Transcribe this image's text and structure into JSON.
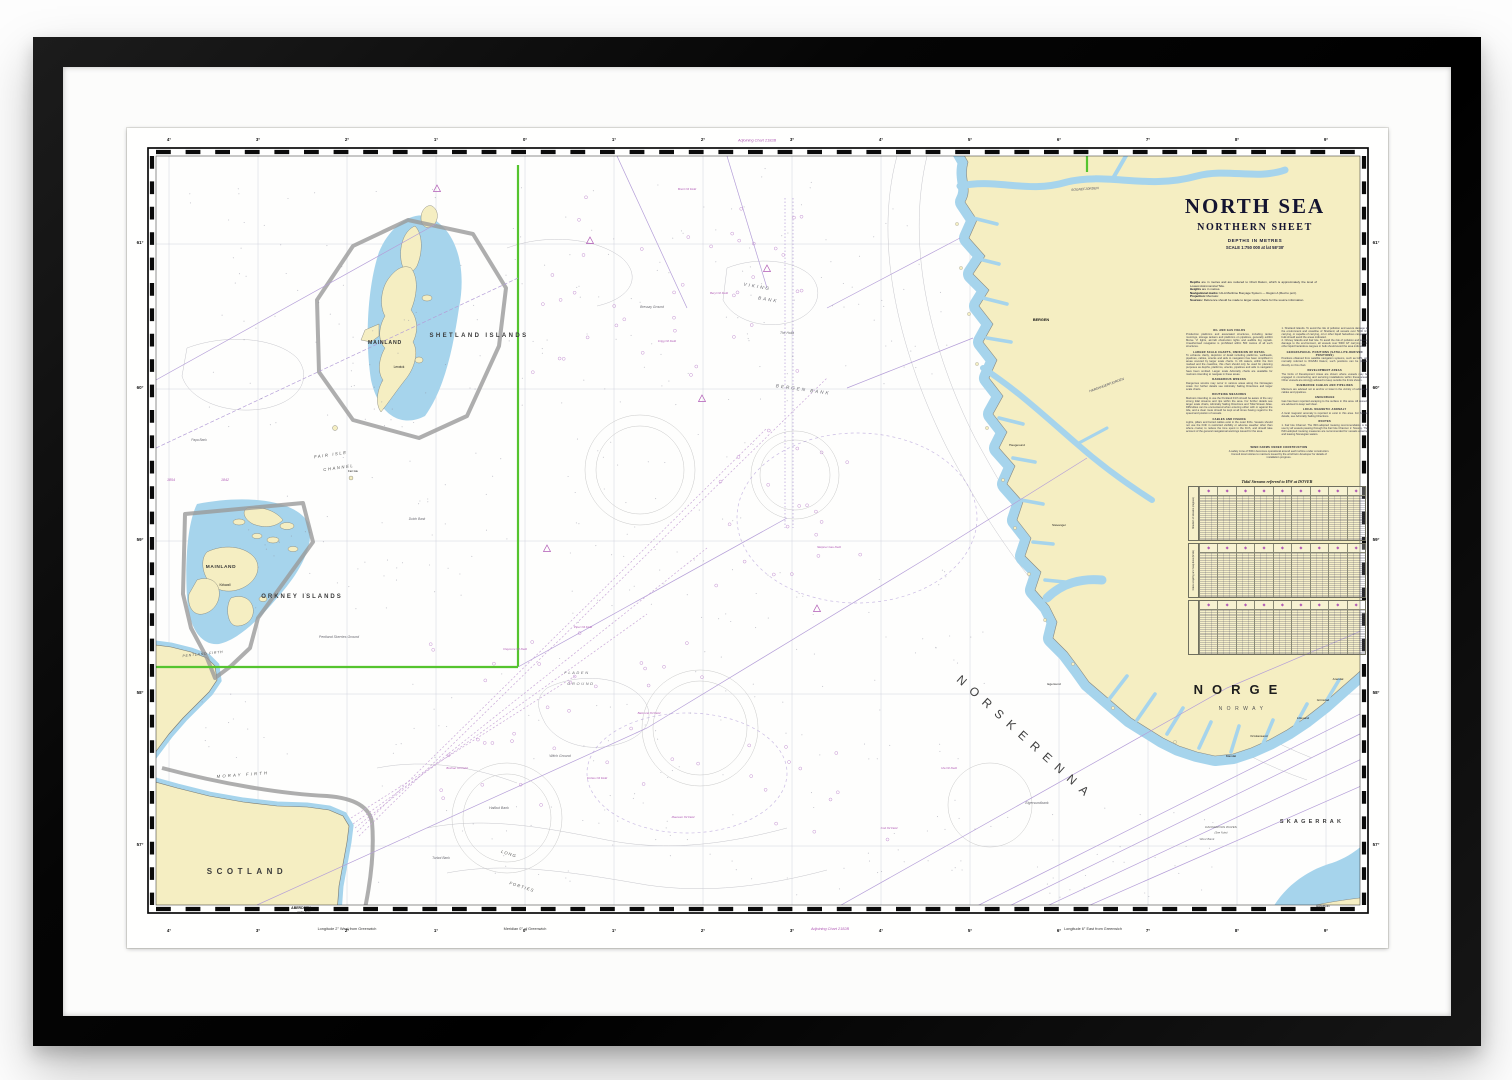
{
  "artwork": {
    "title": "NORTH SEA",
    "subtitle": "NORTHERN SHEET",
    "depths_line": "DEPTHS IN METRES",
    "scale_line": "SCALE 1:750 000 at lat 58°30'",
    "intro": [
      {
        "lead": "Depths",
        "text": "are in metres and are reduced to Chart Datum, which is approximately the level of Lowest Astronomical Tide."
      },
      {
        "lead": "Heights",
        "text": "are in metres."
      },
      {
        "lead": "Navigational marks:",
        "text": "IALA Maritime Buoyage System — Region A (Red to port)."
      },
      {
        "lead": "Projection:",
        "text": "Mercator."
      },
      {
        "lead": "Sources:",
        "text": "Reference should be made to larger scale charts for the source information."
      }
    ]
  },
  "notes_col1": [
    {
      "h": "OIL AND GAS FIELDS",
      "p": "Production platforms and associated structures, including tanker moorings, storage tankers and platforms on pipelines, generally exhibit Morse 'U' lights, aircraft obstruction lights and audible fog signals. Unauthorised navigation is prohibited within 500 metres of all such structures."
    },
    {
      "h": "LARGER SCALE CHARTS, OMISSION OF DETAIL",
      "p": "To enhance clarity, depiction of detail including platforms, wellheads, pipelines, cables, wrecks and aids to navigation has been simplified in areas covered by larger scale charts. In UK waters, within the limit marked and the coastline, this chart should only be used for planning purposes as depths, platforms, wrecks, pipelines and aids to navigation have been omitted. Larger scale Admiralty charts are available for mariners intending to navigate in these areas."
    },
    {
      "h": "DANGEROUS WRECKS",
      "p": "Dangerous wrecks may occur in various areas along the Norwegian coast. For further details see Admiralty Sailing Directions and larger scale charts."
    },
    {
      "h": "ROUTEING MEASURES",
      "p": "Mariners intending to use the Pentland Firth should be aware of the very strong tidal streams and rips within the area. For further details see larger scale charts, Admiralty Sailing Directions and Tidal Stream Atlas. Difficulties can be encountered when entering either with or against the tide, and a clear route should be kept at all times having regard to the speed and position of vessels."
    },
    {
      "h": "CABLES AND FISHING",
      "p": "Lights, pillars and buried cables exist in the outer firths. Vessels should not use the Firth in restricted visibility or adverse weather other than where crucial, to reduce the time spent in the Firth, and should take account of the general navigational warnings issued for the area."
    }
  ],
  "notes_col2": [
    {
      "h": "",
      "p": "1. Shetland Islands. To avoid the risk of pollution and severe damage to the environment and coastline of Shetland, all vessels over 5000 GT carrying, or capable of carrying, oil or other liquid hazardous cargoes in bulk should avoid the areas indicated."
    },
    {
      "h": "",
      "p": "2. Orkney Islands and Fair Isle. To avoid the risk of pollution and severe damage to the environment, all vessels over 5000 GT carrying oil or other liquid hazardous cargoes in bulk should avoid the area indicated."
    },
    {
      "h": "GEOGRAPHICAL POSITIONS (SATELLITE-DERIVED POSITIONS)",
      "p": "Positions obtained from satellite navigation systems, such as GPS, are normally referred to WGS84 Datum; such positions can be plotted directly on this chart."
    },
    {
      "h": "DEVELOPMENT AREAS",
      "p": "The limits of Development Areas are shown where vessels may be engaged in constructing and servicing installations within these areas. Other vessels are strongly advised to keep outside the limits shown."
    },
    {
      "h": "SUBMARINE CABLES AND PIPELINES",
      "p": "Mariners are advised not to anchor or trawl in the vicinity of submarine cables and pipelines."
    },
    {
      "h": "ANCHORAGE",
      "p": "Gas has been reported escaping to the surface in this area. All vessels are advised to keep well clear."
    },
    {
      "h": "LOCAL MAGNETIC ANOMALY",
      "p": "A local magnetic anomaly is reported to exist in this area. For further details, see Admiralty Sailing Directions."
    },
    {
      "h": "ROUTES",
      "p": "1. Fair Isle Channel. The IMO-adopted routeing recommendation is for use by all vessels passing through the Fair Isle Channel. 2. Norway. The IMO-adopted routeing measures are recommended for vessels entering and leaving Norwegian waters."
    }
  ],
  "panel_note": {
    "h": "WIND FARMS UNDER CONSTRUCTION",
    "p": "A safety zone of 500m becomes operational around each turbine under construction. Consult local notices to mariners issued by the wind farm developer for details of installation progress."
  },
  "tide_table": {
    "title": "Tidal Streams referred to HW at DOVER",
    "diamond_glyph": "◆",
    "side_label_1": "Direction of streams (degrees)",
    "side_label_2": "Rates at spring and neap tides (knots)",
    "side_label_3": ""
  },
  "map_labels": [
    {
      "t": "SHETLAND ISLANDS",
      "x": 352,
      "y": 209,
      "s": 6,
      "c": "area",
      "ls": 2.4
    },
    {
      "t": "MAINLAND",
      "x": 258,
      "y": 216,
      "s": 5.2,
      "c": "land-name",
      "ls": 0.8
    },
    {
      "t": "Lerwick",
      "x": 272,
      "y": 240,
      "s": 3.2,
      "c": "town"
    },
    {
      "t": "ORKNEY ISLANDS",
      "x": 175,
      "y": 470,
      "s": 6,
      "c": "area",
      "ls": 2
    },
    {
      "t": "MAINLAND",
      "x": 94,
      "y": 440,
      "s": 4.8,
      "c": "land-name",
      "ls": 0.6
    },
    {
      "t": "Kirkwall",
      "x": 98,
      "y": 458,
      "s": 3.2,
      "c": "town"
    },
    {
      "t": "PENTLAND FIRTH",
      "x": 76,
      "y": 527,
      "s": 3.5,
      "c": "strait",
      "ls": 0.8,
      "r": -6
    },
    {
      "t": "Pentland Skerries Ground",
      "x": 212,
      "y": 510,
      "s": 3.5,
      "c": "bank"
    },
    {
      "t": "FAIR ISLE",
      "x": 204,
      "y": 328,
      "s": 4.2,
      "c": "strait",
      "ls": 1.6,
      "r": -8
    },
    {
      "t": "CHANNEL",
      "x": 212,
      "y": 341,
      "s": 4.2,
      "c": "strait",
      "ls": 1.6,
      "r": -8
    },
    {
      "t": "Papa Bank",
      "x": 72,
      "y": 313,
      "s": 3.2,
      "c": "bank"
    },
    {
      "t": "Fair Isle",
      "x": 226,
      "y": 344,
      "s": 2.8,
      "c": "town"
    },
    {
      "t": "Dutch Bank",
      "x": 290,
      "y": 392,
      "s": 3.2,
      "c": "bank"
    },
    {
      "t": "1854",
      "x": 44,
      "y": 353,
      "s": 3.6,
      "c": "mag"
    },
    {
      "t": "1842",
      "x": 98,
      "y": 353,
      "s": 3.6,
      "c": "mag"
    },
    {
      "t": "VIKING",
      "x": 630,
      "y": 160,
      "s": 4.6,
      "c": "bank",
      "ls": 2,
      "r": 10
    },
    {
      "t": "BANK",
      "x": 641,
      "y": 173,
      "s": 4.6,
      "c": "bank",
      "ls": 2,
      "r": 10
    },
    {
      "t": "BERGEN BANK",
      "x": 676,
      "y": 263,
      "s": 4.6,
      "c": "bank",
      "ls": 2,
      "r": 8
    },
    {
      "t": "Bressay Ground",
      "x": 525,
      "y": 180,
      "s": 3.3,
      "c": "bank"
    },
    {
      "t": "The Holla",
      "x": 660,
      "y": 206,
      "s": 3.3,
      "c": "bank"
    },
    {
      "t": "FLADEN",
      "x": 450,
      "y": 546,
      "s": 4,
      "c": "bank",
      "ls": 1.6
    },
    {
      "t": "GROUND",
      "x": 454,
      "y": 557,
      "s": 4,
      "c": "bank",
      "ls": 1.6
    },
    {
      "t": "Witch Ground",
      "x": 433,
      "y": 629,
      "s": 3.5,
      "c": "bank"
    },
    {
      "t": "Halibut Bank",
      "x": 372,
      "y": 681,
      "s": 3.5,
      "c": "bank"
    },
    {
      "t": "Turbot Bank",
      "x": 314,
      "y": 731,
      "s": 3.3,
      "c": "bank"
    },
    {
      "t": "L O N G",
      "x": 381,
      "y": 727,
      "s": 4.2,
      "c": "strait",
      "r": 18
    },
    {
      "t": "F O R T I E S",
      "x": 394,
      "y": 760,
      "s": 4.2,
      "c": "strait",
      "r": 18
    },
    {
      "t": "MORAY FIRTH",
      "x": 116,
      "y": 648,
      "s": 4.2,
      "c": "strait",
      "ls": 2.2,
      "r": -4
    },
    {
      "t": "SCOTLAND",
      "x": 120,
      "y": 746,
      "s": 8,
      "c": "area",
      "ls": 4.5
    },
    {
      "t": "ABERDEEN",
      "x": 174,
      "y": 781,
      "s": 3.5,
      "c": "city"
    },
    {
      "t": "Girdle Ness",
      "x": 177,
      "y": 785,
      "s": 2.5,
      "c": "town"
    },
    {
      "t": "NORGE",
      "x": 1113,
      "y": 566,
      "s": 13,
      "c": "country",
      "ls": 9
    },
    {
      "t": "NORWAY",
      "x": 1116,
      "y": 582,
      "s": 5,
      "c": "country-sub",
      "ls": 4.5
    },
    {
      "t": "SOGNEFJORDEN",
      "x": 958,
      "y": 62,
      "s": 3.3,
      "c": "fjord",
      "r": -4
    },
    {
      "t": "HARDANGERFJORDEN",
      "x": 980,
      "y": 258,
      "s": 3.3,
      "c": "fjord",
      "r": -20
    },
    {
      "t": "BERGEN",
      "x": 914,
      "y": 193,
      "s": 3.8,
      "c": "city"
    },
    {
      "t": "Haugesund",
      "x": 890,
      "y": 318,
      "s": 3.1,
      "c": "town"
    },
    {
      "t": "Stavanger",
      "x": 932,
      "y": 398,
      "s": 3.1,
      "c": "town"
    },
    {
      "t": "Egersund",
      "x": 927,
      "y": 557,
      "s": 3.1,
      "c": "town"
    },
    {
      "t": "Mandal",
      "x": 1104,
      "y": 629,
      "s": 3.1,
      "c": "town"
    },
    {
      "t": "Kristiansand",
      "x": 1132,
      "y": 609,
      "s": 3.1,
      "c": "town"
    },
    {
      "t": "Lillesand",
      "x": 1176,
      "y": 591,
      "s": 3.1,
      "c": "town"
    },
    {
      "t": "Grimstad",
      "x": 1196,
      "y": 573,
      "s": 3.1,
      "c": "town"
    },
    {
      "t": "Arendal",
      "x": 1211,
      "y": 552,
      "s": 3.1,
      "c": "town"
    },
    {
      "t": "SKAGERRAK",
      "x": 1185,
      "y": 695,
      "s": 5.5,
      "c": "area",
      "ls": 3.2
    },
    {
      "t": "NORSKERENNA",
      "x": 896,
      "y": 613,
      "s": 12,
      "c": "trench",
      "ls": 8,
      "r": 42
    },
    {
      "t": "Eigersundbank",
      "x": 910,
      "y": 676,
      "s": 3.5,
      "c": "bank"
    },
    {
      "t": "DANGEROUS WAVES",
      "x": 1094,
      "y": 700,
      "s": 3.1,
      "c": "warn"
    },
    {
      "t": "(See Note)",
      "x": 1094,
      "y": 705.5,
      "s": 2.7,
      "c": "warn"
    },
    {
      "t": "Hanstholm",
      "x": 1196,
      "y": 779,
      "s": 2.9,
      "c": "town"
    },
    {
      "t": "West Bank",
      "x": 1080,
      "y": 712,
      "s": 3.1,
      "c": "bank"
    },
    {
      "t": "Brent Oil Field",
      "x": 560,
      "y": 62,
      "s": 2.9,
      "c": "mag"
    },
    {
      "t": "Beryl Oil Field",
      "x": 592,
      "y": 166,
      "s": 2.9,
      "c": "mag"
    },
    {
      "t": "Frigg Oil Field",
      "x": 540,
      "y": 214,
      "s": 2.9,
      "c": "mag"
    },
    {
      "t": "Sleipner Gas Field",
      "x": 702,
      "y": 420,
      "s": 2.9,
      "c": "mag"
    },
    {
      "t": "Piper Oil Field",
      "x": 456,
      "y": 500,
      "s": 2.9,
      "c": "mag"
    },
    {
      "t": "Claymore Oil Field",
      "x": 388,
      "y": 522,
      "s": 2.9,
      "c": "mag"
    },
    {
      "t": "Balmoral Oil Field",
      "x": 522,
      "y": 586,
      "s": 2.9,
      "c": "mag"
    },
    {
      "t": "Buchan Oil Field",
      "x": 330,
      "y": 641,
      "s": 2.9,
      "c": "mag"
    },
    {
      "t": "Forties Oil Field",
      "x": 470,
      "y": 651,
      "s": 2.9,
      "c": "mag"
    },
    {
      "t": "Maureen Oil Field",
      "x": 556,
      "y": 690,
      "s": 2.9,
      "c": "mag"
    },
    {
      "t": "Ula Oil Field",
      "x": 822,
      "y": 641,
      "s": 2.9,
      "c": "mag"
    },
    {
      "t": "Cod Oil Field",
      "x": 762,
      "y": 701,
      "s": 2.9,
      "c": "mag"
    }
  ],
  "margin": {
    "lat_labels": [
      {
        "t": "61°",
        "y": 116
      },
      {
        "t": "60°",
        "y": 261
      },
      {
        "t": "59°",
        "y": 413
      },
      {
        "t": "58°",
        "y": 566
      },
      {
        "t": "57°",
        "y": 718
      }
    ],
    "lon_labels": [
      {
        "t": "4°",
        "x": 42
      },
      {
        "t": "3°",
        "x": 131
      },
      {
        "t": "2°",
        "x": 220
      },
      {
        "t": "1°",
        "x": 309
      },
      {
        "t": "0°",
        "x": 398
      },
      {
        "t": "1°",
        "x": 487
      },
      {
        "t": "2°",
        "x": 576
      },
      {
        "t": "3°",
        "x": 665
      },
      {
        "t": "4°",
        "x": 754
      },
      {
        "t": "5°",
        "x": 843
      },
      {
        "t": "6°",
        "x": 932
      },
      {
        "t": "7°",
        "x": 1021
      },
      {
        "t": "8°",
        "x": 1110
      },
      {
        "t": "9°",
        "x": 1199
      }
    ],
    "notes": [
      {
        "t": "Adjoining Chart 2182B",
        "x": 630,
        "y": 13.5,
        "c": "mag"
      },
      {
        "t": "Longitude 2° West from Greenwich",
        "x": 220,
        "y": 802,
        "c": "marginnote"
      },
      {
        "t": "Meridian 0° of Greenwich",
        "x": 398,
        "y": 802,
        "c": "marginnote"
      },
      {
        "t": "Adjoining Chart 2182B",
        "x": 703,
        "y": 802,
        "c": "mag"
      },
      {
        "t": "Longitude 6° East from Greenwich",
        "x": 966,
        "y": 802,
        "c": "marginnote"
      }
    ]
  },
  "colors": {
    "land": "#f5eec2",
    "coastal_water": "#a6d4ec",
    "magenta": "#b05ab5",
    "route_lavender": "#b49ed8",
    "reference_green": "#55c42e",
    "limit_grey": "#9a9a9a",
    "frame_black": "#0a0a0a"
  }
}
